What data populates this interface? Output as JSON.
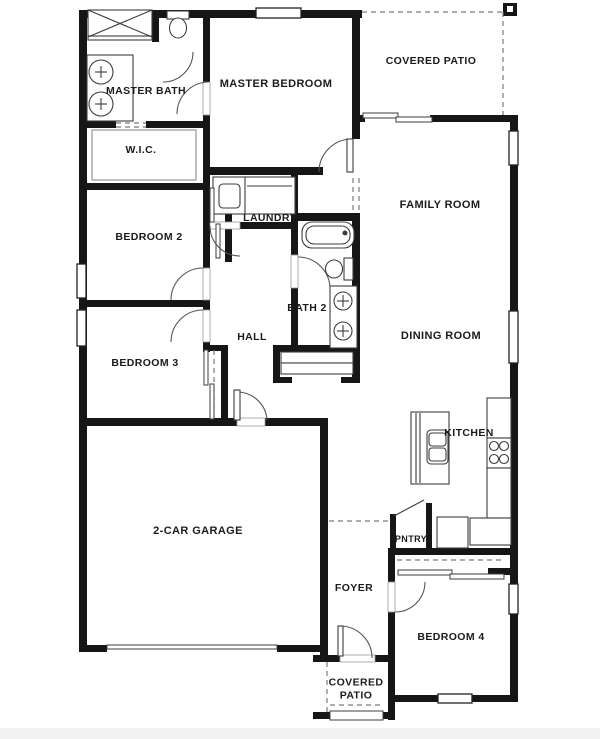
{
  "plan": {
    "width": 600,
    "height": 739,
    "colors": {
      "wall": "#161616",
      "fixture_line": "#3c3c3c",
      "light_line": "#8c8c8c",
      "dash": "#7a7a7a",
      "arc": "#555555",
      "window_border": "#222222",
      "gap_border": "#999999",
      "label": "#1b1b1b",
      "page_band": "#f1f1f1",
      "background": "#ffffff"
    },
    "labels": [
      {
        "id": "master-bath",
        "text": "MASTER BATH",
        "x": 146,
        "y": 90,
        "size": 10.5
      },
      {
        "id": "master-bedroom",
        "text": "MASTER BEDROOM",
        "x": 276,
        "y": 83,
        "size": 11
      },
      {
        "id": "covered-patio-top",
        "text": "COVERED PATIO",
        "x": 431,
        "y": 60,
        "size": 10.5
      },
      {
        "id": "wic",
        "text": "W.I.C.",
        "x": 141,
        "y": 149,
        "size": 10.5
      },
      {
        "id": "family-room",
        "text": "FAMILY ROOM",
        "x": 440,
        "y": 204,
        "size": 11
      },
      {
        "id": "bedroom-2",
        "text": "BEDROOM 2",
        "x": 149,
        "y": 236,
        "size": 10.5
      },
      {
        "id": "laundry",
        "text": "LAUNDRY",
        "x": 270,
        "y": 217,
        "size": 10.5
      },
      {
        "id": "bath-2",
        "text": "BATH 2",
        "x": 307,
        "y": 307,
        "size": 10.5
      },
      {
        "id": "hall",
        "text": "HALL",
        "x": 252,
        "y": 336,
        "size": 10.5
      },
      {
        "id": "bedroom-3",
        "text": "BEDROOM 3",
        "x": 145,
        "y": 362,
        "size": 10.5
      },
      {
        "id": "dining-room",
        "text": "DINING ROOM",
        "x": 441,
        "y": 335,
        "size": 11
      },
      {
        "id": "kitchen",
        "text": "KITCHEN",
        "x": 469,
        "y": 432,
        "size": 10.5
      },
      {
        "id": "garage",
        "text": "2-CAR GARAGE",
        "x": 198,
        "y": 530,
        "size": 11
      },
      {
        "id": "pantry",
        "text": "PNTRY",
        "x": 411,
        "y": 538,
        "size": 9
      },
      {
        "id": "foyer",
        "text": "FOYER",
        "x": 354,
        "y": 587,
        "size": 10.5
      },
      {
        "id": "bedroom-4",
        "text": "BEDROOM 4",
        "x": 451,
        "y": 636,
        "size": 10.5
      },
      {
        "id": "covered-patio-bottom",
        "text": "COVERED PATIO",
        "lines": [
          "COVERED",
          "PATIO"
        ],
        "x": 356,
        "y": 688,
        "size": 10.5
      }
    ],
    "walls": [
      [
        79,
        10,
        8,
        642
      ],
      [
        87,
        10,
        275,
        8
      ],
      [
        352,
        18,
        8,
        121
      ],
      [
        203,
        167,
        120,
        8
      ],
      [
        203,
        10,
        7,
        72
      ],
      [
        203,
        115,
        7,
        114
      ],
      [
        152,
        10,
        7,
        32
      ],
      [
        79,
        121,
        37,
        7
      ],
      [
        146,
        121,
        59,
        7
      ],
      [
        79,
        183,
        131,
        7
      ],
      [
        203,
        190,
        7,
        78
      ],
      [
        203,
        300,
        7,
        10
      ],
      [
        203,
        342,
        7,
        10
      ],
      [
        79,
        300,
        124,
        7
      ],
      [
        225,
        183,
        7,
        79
      ],
      [
        221,
        345,
        7,
        78
      ],
      [
        203,
        345,
        25,
        6
      ],
      [
        79,
        418,
        158,
        8
      ],
      [
        265,
        418,
        63,
        8
      ],
      [
        320,
        426,
        8,
        234
      ],
      [
        79,
        645,
        28,
        7
      ],
      [
        277,
        645,
        43,
        7
      ],
      [
        313,
        655,
        27,
        7
      ],
      [
        375,
        655,
        20,
        7
      ],
      [
        388,
        655,
        7,
        65
      ],
      [
        313,
        712,
        17,
        7
      ],
      [
        383,
        712,
        12,
        7
      ],
      [
        352,
        115,
        13,
        7
      ],
      [
        430,
        115,
        88,
        7
      ],
      [
        510,
        115,
        8,
        587
      ],
      [
        388,
        695,
        50,
        7
      ],
      [
        472,
        695,
        44,
        7
      ],
      [
        388,
        548,
        128,
        7
      ],
      [
        388,
        555,
        7,
        27
      ],
      [
        388,
        612,
        7,
        43
      ],
      [
        291,
        174,
        7,
        55
      ],
      [
        240,
        222,
        58,
        7
      ],
      [
        298,
        213,
        62,
        8
      ],
      [
        291,
        223,
        7,
        32
      ],
      [
        291,
        288,
        7,
        57
      ],
      [
        352,
        213,
        8,
        170
      ],
      [
        273,
        345,
        87,
        7
      ],
      [
        273,
        352,
        7,
        31
      ],
      [
        273,
        377,
        19,
        6
      ],
      [
        341,
        377,
        19,
        6
      ],
      [
        503,
        3,
        14,
        13
      ],
      [
        390,
        514,
        6,
        36
      ],
      [
        426,
        503,
        6,
        47
      ],
      [
        488,
        568,
        24,
        7
      ]
    ],
    "door_gaps": [
      [
        203,
        82,
        7,
        33
      ],
      [
        203,
        268,
        7,
        32
      ],
      [
        203,
        310,
        7,
        32
      ],
      [
        291,
        255,
        7,
        33
      ],
      [
        210,
        222,
        30,
        7
      ],
      [
        237,
        418,
        28,
        8
      ],
      [
        340,
        655,
        35,
        7
      ],
      [
        388,
        582,
        7,
        30
      ]
    ],
    "door_leaves": [
      [
        347,
        139,
        6,
        33
      ],
      [
        234,
        390,
        6,
        30
      ],
      [
        338,
        626,
        5,
        30
      ]
    ],
    "arcs": [
      "M177,114 A32,32 0 0 1 209,82",
      "M193,52 A30,30 0 0 1 163,82",
      "M203,268 A32,32 0 0 0 171,300",
      "M171,342 A32,32 0 0 1 203,310",
      "M298,257 A32,32 0 0 1 330,289",
      "M210,226 A30,30 0 0 0 240,256",
      "M319,172 A33,33 0 0 1 352,139",
      "M267,420 A30,30 0 0 0 237,392",
      "M340,626 A32,32 0 0 1 372,658",
      "M395,612 A30,30 0 0 0 425,582"
    ],
    "windows": [
      [
        256,
        8,
        45,
        10
      ],
      [
        77,
        264,
        9,
        34
      ],
      [
        77,
        310,
        9,
        36
      ],
      [
        509,
        131,
        9,
        34
      ],
      [
        509,
        311,
        9,
        52
      ],
      [
        509,
        584,
        9,
        30
      ],
      [
        438,
        694,
        34,
        9
      ]
    ],
    "slider_panels": [
      [
        363,
        113,
        35,
        5
      ],
      [
        396,
        117,
        36,
        5
      ],
      [
        398,
        570,
        54,
        5
      ],
      [
        450,
        574,
        54,
        5
      ],
      [
        204,
        350,
        4,
        35
      ],
      [
        210,
        384,
        4,
        35
      ],
      [
        210,
        188,
        4,
        34
      ],
      [
        216,
        224,
        4,
        34
      ],
      [
        330,
        711,
        53,
        9
      ],
      [
        107,
        645,
        170,
        4
      ]
    ],
    "dashes": [
      [
        362,
        12,
        503,
        12
      ],
      [
        503,
        12,
        503,
        115
      ],
      [
        353,
        178,
        353,
        212
      ],
      [
        359,
        178,
        359,
        212
      ],
      [
        329,
        521,
        392,
        521
      ],
      [
        327,
        662,
        327,
        712
      ],
      [
        330,
        705,
        383,
        705
      ],
      [
        116,
        123,
        146,
        123
      ],
      [
        116,
        127,
        146,
        127
      ],
      [
        397,
        560,
        502,
        560
      ],
      [
        214,
        350,
        214,
        418
      ],
      [
        500,
        400,
        500,
        436
      ],
      [
        497,
        468,
        497,
        516
      ],
      [
        476,
        530,
        508,
        530
      ],
      [
        413,
        478,
        447,
        478
      ]
    ],
    "dash_rects": [
      [
        441,
        521,
        23,
        23
      ]
    ],
    "outline_rects": [
      [
        88,
        10,
        64,
        27,
        "shower"
      ],
      [
        88,
        36,
        64,
        4,
        "shower-door"
      ],
      [
        87,
        55,
        46,
        66,
        "master-vanity"
      ],
      [
        213,
        177,
        82,
        37,
        "washer-dryer"
      ],
      [
        330,
        286,
        27,
        62,
        "bath2-vanity"
      ],
      [
        411,
        412,
        38,
        72,
        "kitchen-island"
      ],
      [
        487,
        398,
        24,
        40,
        "kitchen-counter-upper"
      ],
      [
        487,
        438,
        24,
        30,
        "stove"
      ],
      [
        487,
        468,
        24,
        50,
        "kitchen-counter-lower"
      ],
      [
        470,
        518,
        41,
        27,
        "kitchen-counter-foot"
      ],
      [
        437,
        517,
        31,
        31,
        "refrigerator"
      ],
      [
        344,
        258,
        9,
        22,
        "bath2-toilet-tank"
      ],
      [
        167,
        11,
        22,
        8,
        "wc-toilet-tank"
      ],
      [
        281,
        352,
        72,
        11,
        "linen-shelf"
      ],
      [
        281,
        363,
        72,
        11,
        "linen-shelf"
      ]
    ],
    "light_rects": [
      [
        92,
        130,
        104,
        50,
        "wic-shelf"
      ]
    ],
    "rounded_rects": [
      [
        219,
        184,
        21,
        24,
        4,
        "washer-drum"
      ],
      [
        302,
        222,
        52,
        26,
        10,
        "tub"
      ],
      [
        306,
        226,
        44,
        18,
        8,
        "tub-inner"
      ],
      [
        427,
        430,
        21,
        34,
        4,
        "island-sink"
      ],
      [
        429,
        433,
        17,
        13,
        3,
        "sink-basin"
      ],
      [
        429,
        448,
        17,
        13,
        3,
        "sink-basin"
      ]
    ],
    "circles": [
      [
        101,
        72,
        12,
        "sink"
      ],
      [
        101,
        104,
        12,
        "sink"
      ],
      [
        343,
        301,
        9,
        "sink"
      ],
      [
        343,
        331,
        9,
        "sink"
      ],
      [
        494,
        446,
        4.5,
        "burner"
      ],
      [
        504,
        446,
        4.5,
        "burner"
      ],
      [
        494,
        459,
        4.5,
        "burner"
      ],
      [
        504,
        459,
        4.5,
        "burner"
      ],
      [
        345,
        233,
        2,
        "tub-faucet"
      ]
    ],
    "ellipses": [
      [
        178,
        28,
        8.5,
        10,
        "wc-toilet-bowl"
      ],
      [
        334,
        269,
        8.5,
        9,
        "bath2-toilet-bowl"
      ]
    ],
    "lines": [
      [
        88,
        10,
        152,
        37
      ],
      [
        152,
        10,
        88,
        37
      ],
      [
        245,
        177,
        245,
        214
      ],
      [
        247,
        186,
        292,
        186
      ],
      [
        394,
        516,
        424,
        500
      ],
      [
        416,
        413,
        416,
        483
      ],
      [
        420,
        413,
        420,
        483
      ],
      [
        95,
        72,
        107,
        72
      ],
      [
        101,
        66,
        101,
        78
      ],
      [
        95,
        104,
        107,
        104
      ],
      [
        101,
        98,
        101,
        110
      ],
      [
        337,
        301,
        349,
        301
      ],
      [
        343,
        295,
        343,
        307
      ],
      [
        337,
        331,
        349,
        331
      ],
      [
        343,
        325,
        343,
        337
      ]
    ],
    "post_inner": [
      507,
      6,
      6,
      6
    ],
    "page_band": [
      0,
      728,
      600,
      11
    ]
  }
}
